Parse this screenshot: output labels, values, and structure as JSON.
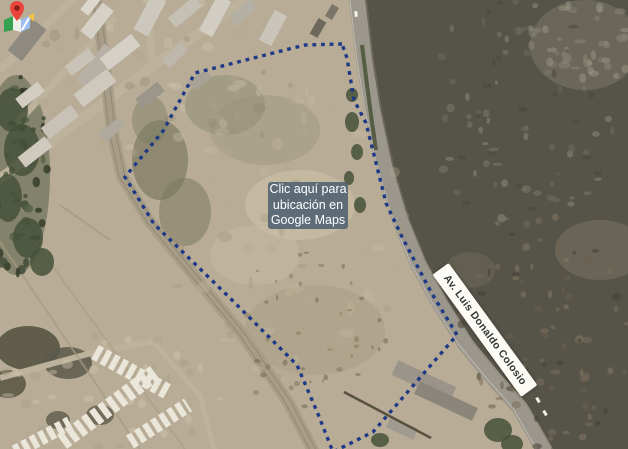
{
  "cta": {
    "lines": [
      "Clic aquí para",
      "ubicación en",
      "Google Maps"
    ],
    "bg_color": "rgba(80,97,114,0.88)",
    "icon": "google-maps-pin-icon"
  },
  "road_label": {
    "text": "Av. Luis Donaldo Colosio",
    "angle_deg": 54
  },
  "scene": {
    "width": 628,
    "height": 449,
    "colors": {
      "base": "#b8ac96",
      "scrub": "#565349",
      "highway": "#9c978d",
      "highway_edge": "#d2cec4",
      "median_green": "#4a5238",
      "west_road": "#a89e88",
      "industrial_road": "#bdb29b",
      "boundary": "#1e3a86",
      "tree": "#46513a",
      "unit_row": "#eae6da",
      "wall": "#57523f",
      "car": "#f2f1ec"
    },
    "boundary_points": [
      [
        342,
        44
      ],
      [
        305,
        45
      ],
      [
        285,
        50
      ],
      [
        195,
        73
      ],
      [
        163,
        131
      ],
      [
        125,
        177
      ],
      [
        154,
        224
      ],
      [
        230,
        298
      ],
      [
        297,
        365
      ],
      [
        318,
        414
      ],
      [
        333,
        452
      ],
      [
        343,
        447
      ],
      [
        373,
        432
      ],
      [
        457,
        335
      ],
      [
        431,
        292
      ],
      [
        401,
        235
      ],
      [
        386,
        203
      ],
      [
        366,
        123
      ],
      [
        354,
        100
      ],
      [
        347,
        58
      ],
      [
        342,
        44
      ]
    ],
    "highway_points": [
      [
        356,
        -8
      ],
      [
        364,
        60
      ],
      [
        372,
        110
      ],
      [
        385,
        170
      ],
      [
        400,
        220
      ],
      [
        418,
        264
      ],
      [
        440,
        304
      ],
      [
        466,
        345
      ],
      [
        495,
        380
      ],
      [
        520,
        408
      ],
      [
        545,
        452
      ]
    ],
    "median_points": [
      [
        362,
        45
      ],
      [
        367,
        85
      ],
      [
        371,
        115
      ],
      [
        376,
        150
      ]
    ],
    "west_road_points": [
      [
        96,
        -5
      ],
      [
        104,
        60
      ],
      [
        112,
        130
      ],
      [
        122,
        176
      ],
      [
        150,
        222
      ],
      [
        196,
        278
      ],
      [
        242,
        334
      ],
      [
        288,
        402
      ],
      [
        314,
        452
      ]
    ],
    "industrial_roads": [
      {
        "pts": [
          [
            252,
            -5
          ],
          [
            150,
            68
          ],
          [
            60,
            135
          ],
          [
            -5,
            182
          ]
        ],
        "w": 10
      },
      {
        "pts": [
          [
            77,
            -5
          ],
          [
            0,
            70
          ]
        ],
        "w": 8
      },
      {
        "pts": [
          [
            115,
            18
          ],
          [
            15,
            125
          ]
        ],
        "w": 7
      },
      {
        "pts": [
          [
            148,
            -4
          ],
          [
            152,
            64
          ]
        ],
        "w": 7
      },
      {
        "pts": [
          [
            0,
            378
          ],
          [
            95,
            352
          ],
          [
            160,
            340
          ]
        ],
        "w": 6
      },
      {
        "pts": [
          [
            150,
            338
          ],
          [
            200,
            396
          ],
          [
            215,
            452
          ]
        ],
        "w": 5
      }
    ],
    "track_lines": [
      [
        0,
        242,
        140,
        449,
        2,
        "#a59a82",
        0.7
      ],
      [
        25,
        228,
        185,
        449,
        2,
        "#a59a82",
        0.55
      ],
      [
        60,
        205,
        110,
        240,
        1.5,
        "#998e76",
        0.6
      ]
    ],
    "patches": [
      [
        225,
        105,
        40,
        30,
        "#84846a",
        0.4
      ],
      [
        265,
        130,
        55,
        35,
        "#908b72",
        0.3
      ],
      [
        300,
        205,
        55,
        35,
        "#cfc4ab",
        0.5
      ],
      [
        255,
        255,
        45,
        30,
        "#c9bea5",
        0.4
      ],
      [
        315,
        330,
        70,
        45,
        "#a5987e",
        0.4
      ],
      [
        160,
        160,
        28,
        40,
        "#6d6e55",
        0.55
      ],
      [
        185,
        212,
        26,
        34,
        "#75765c",
        0.5
      ],
      [
        150,
        120,
        18,
        24,
        "#7b7c62",
        0.45
      ],
      [
        16,
        175,
        34,
        100,
        "#4e5840",
        0.5
      ],
      [
        28,
        348,
        32,
        22,
        "#565441",
        0.9
      ],
      [
        68,
        363,
        24,
        16,
        "#5c594a",
        0.85
      ],
      [
        8,
        384,
        18,
        14,
        "#565441",
        0.85
      ],
      [
        100,
        415,
        14,
        10,
        "#5f5c4a",
        0.8
      ],
      [
        58,
        420,
        12,
        9,
        "#5f5c4a",
        0.8
      ],
      [
        600,
        250,
        45,
        30,
        "#7b7663",
        0.5
      ],
      [
        470,
        270,
        25,
        18,
        "#6e6a58",
        0.5
      ],
      [
        585,
        45,
        55,
        45,
        "#83806e",
        0.45
      ]
    ],
    "trees": [
      [
        12,
        110,
        16,
        22
      ],
      [
        22,
        150,
        18,
        26
      ],
      [
        8,
        198,
        14,
        24
      ],
      [
        28,
        238,
        15,
        20
      ],
      [
        42,
        262,
        12,
        14
      ],
      [
        352,
        122,
        7,
        10
      ],
      [
        357,
        152,
        6,
        8
      ],
      [
        349,
        178,
        5,
        7
      ],
      [
        360,
        205,
        6,
        8
      ],
      [
        352,
        95,
        6,
        7
      ],
      [
        498,
        430,
        14,
        12
      ],
      [
        512,
        444,
        11,
        9
      ],
      [
        380,
        440,
        9,
        7
      ]
    ],
    "speckle_groups": [
      {
        "cx": 520,
        "cy": 110,
        "rx": 100,
        "ry": 120,
        "n": 90,
        "rmin": 1.5,
        "rmax": 5,
        "op": 0.55,
        "seed": 7,
        "colors": [
          "#6e6b5c",
          "#7d7a69",
          "#4a4739",
          "#8b8877"
        ]
      },
      {
        "cx": 545,
        "cy": 330,
        "rx": 85,
        "ry": 120,
        "n": 80,
        "rmin": 1.5,
        "rmax": 5,
        "op": 0.55,
        "seed": 19,
        "colors": [
          "#6b5f4e",
          "#7a6e5a",
          "#463f33",
          "#857a64"
        ]
      },
      {
        "cx": 585,
        "cy": 45,
        "rx": 55,
        "ry": 45,
        "n": 35,
        "rmin": 2,
        "rmax": 6,
        "op": 0.5,
        "seed": 31,
        "colors": [
          "#8d8a78",
          "#9a9784"
        ]
      },
      {
        "cx": 290,
        "cy": 230,
        "rx": 125,
        "ry": 150,
        "n": 70,
        "rmin": 2,
        "rmax": 8,
        "op": 0.35,
        "seed": 43,
        "colors": [
          "#c6baa1",
          "#a2967d",
          "#b4a88f"
        ]
      },
      {
        "cx": 300,
        "cy": 330,
        "rx": 90,
        "ry": 80,
        "n": 40,
        "rmin": 1,
        "rmax": 3.5,
        "op": 0.5,
        "seed": 57,
        "colors": [
          "#7d7258",
          "#6b6149"
        ]
      },
      {
        "cx": 150,
        "cy": 80,
        "rx": 150,
        "ry": 85,
        "n": 50,
        "rmin": 2,
        "rmax": 7,
        "op": 0.35,
        "seed": 71,
        "colors": [
          "#cfc5ae",
          "#b1a790",
          "#8f8672"
        ]
      },
      {
        "cx": 110,
        "cy": 390,
        "rx": 115,
        "ry": 65,
        "n": 40,
        "rmin": 2,
        "rmax": 6,
        "op": 0.4,
        "seed": 83,
        "colors": [
          "#d2c7b0",
          "#a89d85"
        ]
      },
      {
        "cx": 18,
        "cy": 170,
        "rx": 30,
        "ry": 110,
        "n": 45,
        "rmin": 2,
        "rmax": 6,
        "op": 0.8,
        "seed": 97,
        "colors": [
          "#3f4a34",
          "#556044",
          "#2f3826"
        ]
      }
    ],
    "buildings": [
      [
        27,
        40,
        40,
        18,
        -52,
        "#8f8a80"
      ],
      [
        97,
        21,
        36,
        14,
        -52,
        "#d6d1c7"
      ],
      [
        98,
        68,
        46,
        20,
        -52,
        "#b7b1a5"
      ],
      [
        91,
        4,
        22,
        10,
        -52,
        "#dcd7cd"
      ],
      [
        150,
        15,
        40,
        16,
        -62,
        "#cdc8bd"
      ],
      [
        185,
        12,
        34,
        13,
        -40,
        "#c5c0b4"
      ],
      [
        215,
        16,
        40,
        15,
        -62,
        "#d2cdc2"
      ],
      [
        243,
        12,
        28,
        12,
        -40,
        "#b5b0a4"
      ],
      [
        273,
        28,
        34,
        14,
        -62,
        "#cac5ba"
      ],
      [
        120,
        52,
        40,
        15,
        -38,
        "#d5d0c5"
      ],
      [
        80,
        62,
        30,
        12,
        -38,
        "#c9c3b7"
      ],
      [
        95,
        88,
        42,
        16,
        -38,
        "#cfc9bd"
      ],
      [
        150,
        95,
        28,
        12,
        -38,
        "#9b968a"
      ],
      [
        60,
        122,
        38,
        14,
        -38,
        "#c8c2b6"
      ],
      [
        35,
        152,
        34,
        13,
        -38,
        "#d0cabe"
      ],
      [
        112,
        130,
        26,
        11,
        -38,
        "#b0aa9e"
      ],
      [
        30,
        95,
        28,
        12,
        -38,
        "#d3cdc1"
      ],
      [
        200,
        80,
        22,
        10,
        -38,
        "#a8a296"
      ],
      [
        175,
        55,
        26,
        11,
        -45,
        "#beb8ac"
      ],
      [
        318,
        28,
        18,
        9,
        -60,
        "#6e685c"
      ],
      [
        332,
        12,
        14,
        8,
        -60,
        "#7a7468"
      ],
      [
        424,
        381,
        64,
        16,
        25,
        "#9a948a"
      ],
      [
        446,
        401,
        64,
        14,
        25,
        "#8b857b"
      ],
      [
        402,
        428,
        30,
        12,
        25,
        "#a09a90"
      ]
    ],
    "unit_rows": [
      [
        95,
        352,
        170,
        393,
        16,
        6,
        3.5
      ],
      [
        62,
        442,
        155,
        373,
        17,
        6.5,
        3.5
      ],
      [
        130,
        442,
        188,
        405,
        15,
        6,
        3.5
      ],
      [
        15,
        452,
        70,
        423,
        14,
        6,
        3.5
      ]
    ],
    "walls": [
      [
        344,
        392,
        431,
        438
      ]
    ],
    "cars": [
      [
        538,
        400,
        60
      ],
      [
        545,
        413,
        60
      ],
      [
        356,
        14,
        85
      ]
    ]
  }
}
